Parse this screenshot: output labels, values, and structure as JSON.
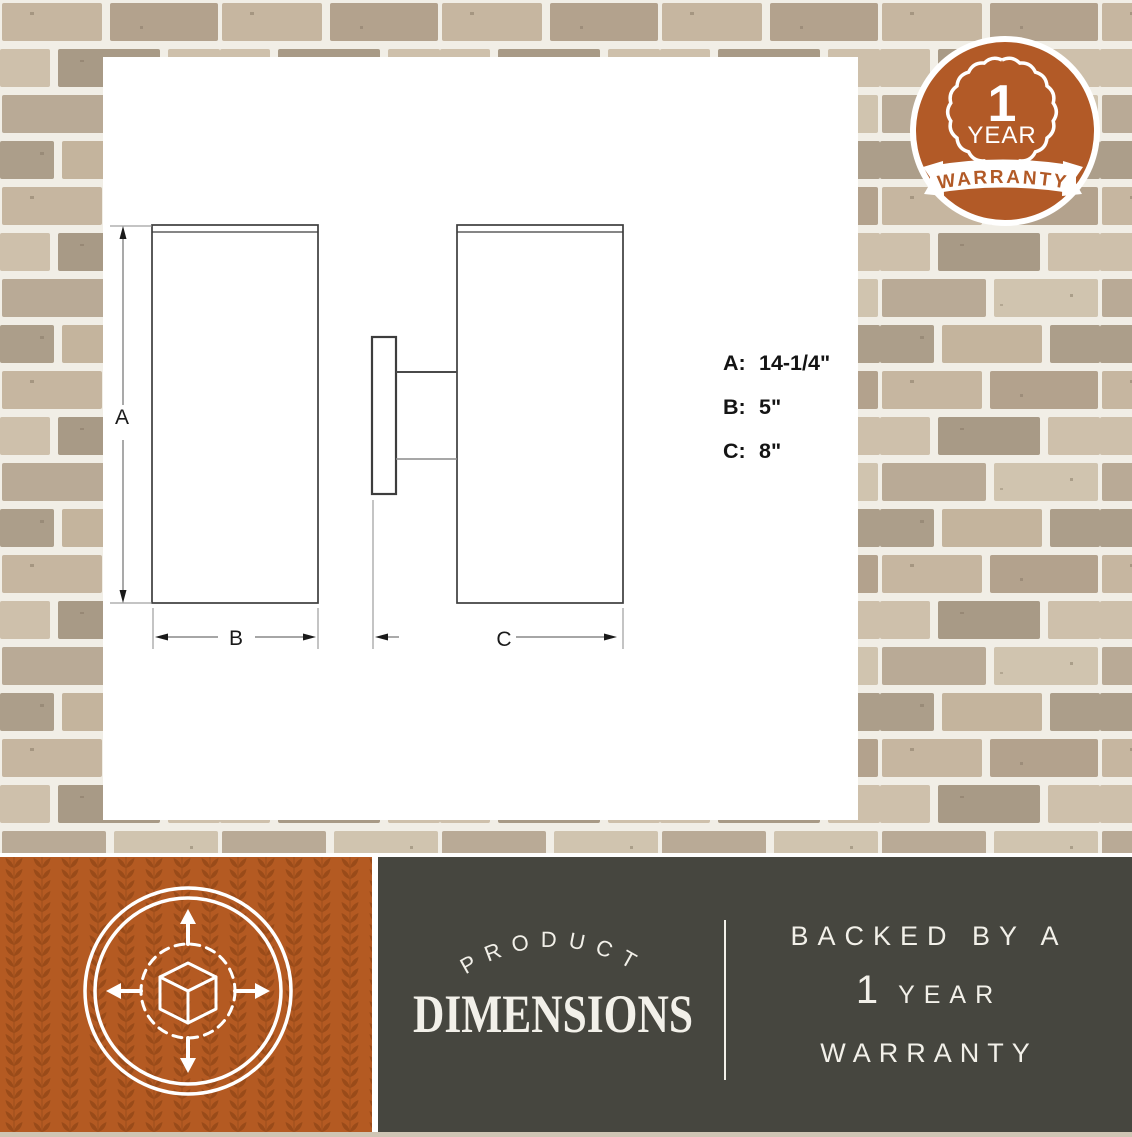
{
  "warranty_badge": {
    "value": "1",
    "unit": "YEAR",
    "ribbon_label": "WARRANTY"
  },
  "diagram": {
    "dim_letters": {
      "a": "A",
      "b": "B",
      "c": "C"
    },
    "specs": [
      {
        "label": "A:",
        "value": "14-1/4\""
      },
      {
        "label": "B:",
        "value": "5\""
      },
      {
        "label": "C:",
        "value": "8\""
      }
    ]
  },
  "banner": {
    "arc_title": "PRODUCT",
    "main_title": "DIMENSIONS",
    "backed_line": "BACKED BY A",
    "year_value": "1",
    "year_unit": "YEAR",
    "warranty_line": "WARRANTY"
  },
  "colors": {
    "accent_orange": "#b25a27",
    "panel_dark": "#46463f",
    "drawing_line": "#3d3d3d",
    "mortar_white": "#f1eee6"
  }
}
